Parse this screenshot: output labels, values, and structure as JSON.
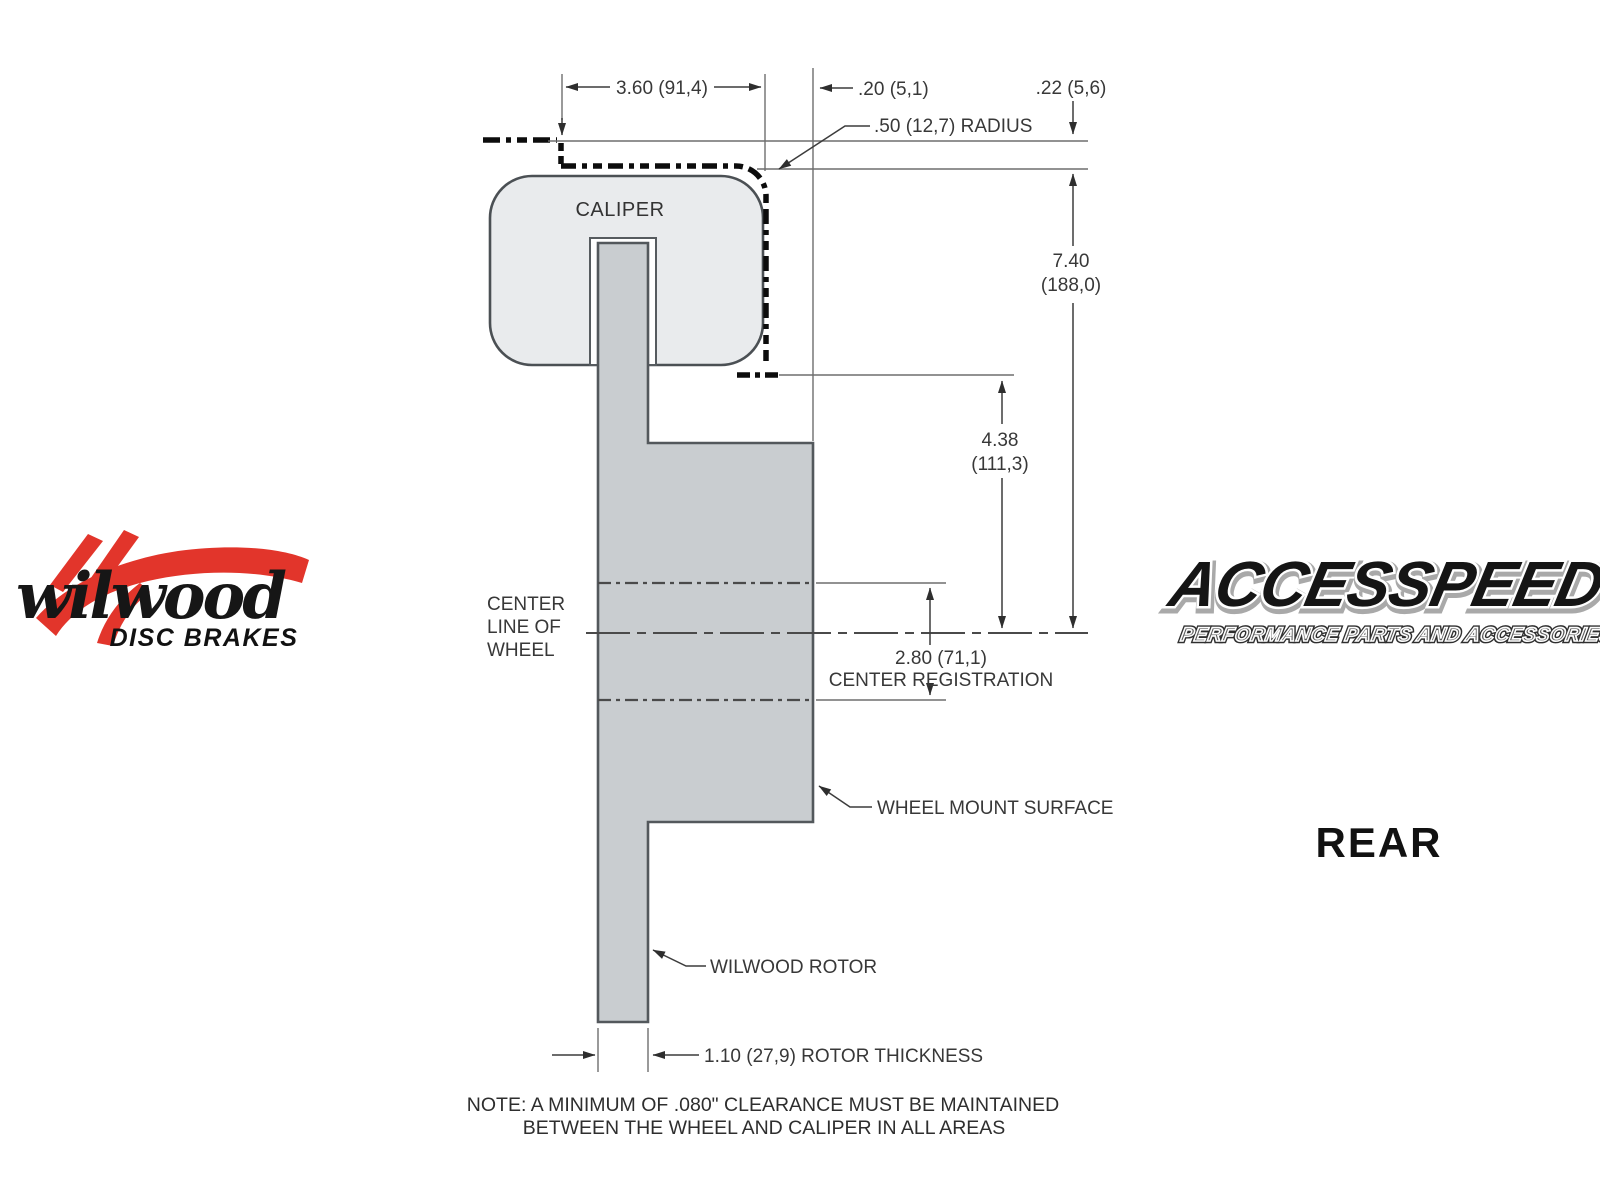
{
  "drawing": {
    "labels": {
      "caliper": "CALIPER",
      "center_line": [
        "CENTER",
        "LINE OF",
        "WHEEL"
      ],
      "wheel_mount_surface": "WHEEL MOUNT SURFACE",
      "wilwood_rotor": "WILWOOD ROTOR"
    },
    "dimensions": {
      "caliper_width": "3.60 (91,4)",
      "side_clearance": ".20 (5,1)",
      "top_clearance": ".22 (5,6)",
      "corner_radius": ".50 (12,7) RADIUS",
      "overall_height_in": "7.40",
      "overall_height_mm": "(188,0)",
      "mount_depth_in": "4.38",
      "mount_depth_mm": "(111,3)",
      "registration_in": "2.80 (71,1)",
      "registration_label": "CENTER REGISTRATION",
      "rotor_thickness": "1.10 (27,9) ROTOR THICKNESS"
    },
    "note": {
      "line1": "NOTE: A MINIMUM OF .080\" CLEARANCE MUST BE MAINTAINED",
      "line2": "BETWEEN THE WHEEL AND CALIPER IN ALL AREAS"
    }
  },
  "branding": {
    "wilwood_script": "wilwood",
    "wilwood_tagline": "DISC BRAKES",
    "accesspeed_name": "ACCESSPEED",
    "accesspeed_tagline": "PERFORMANCE PARTS AND ACCESSORIES",
    "view_label": "REAR"
  },
  "colors": {
    "caliper_fill": "#e9ebed",
    "rotor_fill": "#c9cdd0",
    "outline": "#4b5054",
    "thin_line": "#6e6e6e",
    "phantom_dash": "#0c0c0c",
    "wilwood_red": "#e2352b",
    "text": "#383838"
  }
}
